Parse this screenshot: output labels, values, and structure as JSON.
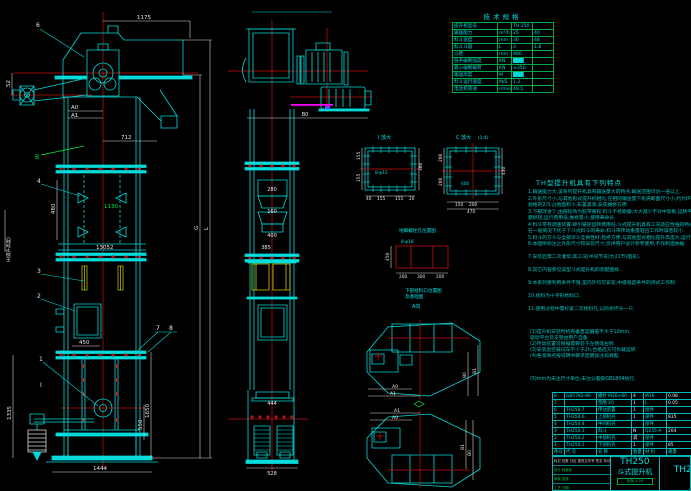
{
  "spec": {
    "title": "技术规格",
    "rows": [
      [
        "提升机型号",
        "",
        "TH 250",
        ""
      ],
      [
        "输送能力",
        "m³/h",
        "25",
        "40"
      ],
      [
        "料斗宽度",
        "mm",
        "30",
        "48"
      ],
      [
        "料斗斗容",
        "L",
        "3",
        "1.8"
      ],
      [
        "斗距",
        "mm",
        "480",
        ""
      ],
      [
        "链条破断强度",
        "KN",
        "███",
        ""
      ],
      [
        "最小破断载荷",
        "KN",
        "≥350",
        ""
      ],
      [
        "输送高度",
        "M",
        "███",
        ""
      ],
      [
        "料斗运行速度",
        "M/S",
        "1.2",
        ""
      ],
      [
        "电动机转速",
        "r/min",
        "48.5",
        ""
      ]
    ]
  },
  "notes": {
    "heading": "TH型提升机具有下列特点",
    "lines": [
      "1.输送能力大,该系列提升机具有输送量大的特点,输送范围可达一倍以上.",
      "2.外形尺寸小,与其他形式提升机相比,在相同输送量下机壳断面尺寸小,约为环链式同",
      "   规格的2/3,占地面积小,布置紧凑,安装维修方便.",
      "3.下部改进了,由链轮改为胶带重轮,料斗不易跑偏,大大减少不对中现象,运转平稳,",
      "   磨损轻,运行费用低,维修量小,使用寿命长.",
      "4.料斗带有调速装置,牵引链轮运转费用低,斗式提升机具有工况适应性强的特点,",
      "   在一般情况下优于下斗式料斗的寿命,料斗带传动重量轻且工作时噪音较小.",
      "5.料斗的方斗与全部深斗互换性好,检修方便,与其他型式相比提升高度大,运行平稳.",
      "6.本图所标注之外形尺寸和安装尺寸,仅供用户设计参考使用,不作制造依据.",
      "7.安装后需二次灌浆,其工况(中间节号)为21节(图号).",
      "8.其它内容参见该型斗式提升机的装配图样.",
      "9.本系列受利用条件不限,室内外均可安装,中级强度条件的闭式工作制.",
      "10.给料为十字形给料口.",
      "11.使用过程中需拧紧二次给料孔,以防损坏头一只."
    ],
    "sub": [
      "(1)提升机安装时机壳垂直度偏差不大于10mm,",
      "   驱动平台及支架由用户自备.",
      "(2)传动装置可根据需要装于左侧或右侧.",
      "(3)安装后空载试车不少于2h,合格后方可负载运转.",
      "(4)各润滑点按说明书要求定期加注润滑脂.",
      "(5)mm为未注尺寸单位,未注公差按GB1804执行."
    ]
  },
  "bom": {
    "headers": [
      "件号",
      "代  号",
      "名  称",
      "数量",
      "材  料",
      "重量"
    ],
    "rows": [
      [
        "8",
        "GB5782-86",
        "螺栓 M20×80",
        "4",
        "M16",
        "0.08"
      ],
      [
        "7",
        "",
        "垫圈 20",
        "1",
        "L",
        "0.05"
      ],
      [
        "6",
        "TH250.7",
        "传动装置",
        "1",
        "组件",
        ""
      ],
      [
        "5",
        "TH250.6",
        "上部机壳",
        "1",
        "部件",
        "835"
      ],
      [
        "4",
        "TH250.4",
        "中间机壳",
        "",
        "部件",
        ""
      ],
      [
        "3",
        "TH250.3",
        "料斗",
        "N",
        "Q235-A",
        "204"
      ],
      [
        "2",
        "TH250.2",
        "中部机壳",
        "袋",
        "部件",
        ""
      ],
      [
        "1",
        "TH250.1",
        "下部机壳",
        "1",
        "部件",
        "85"
      ]
    ]
  },
  "title_block": {
    "model": "TH250",
    "product": "斗式提升机",
    "model_right": "TH250",
    "scale": "比例 1:20",
    "rev_header": "标记 处数 分区 更改文件号 签名 年月日",
    "sig1": "设计    标准化",
    "sig2": "审核    批准",
    "sig3": "工艺    日期"
  },
  "dims": {
    "lv_top": "1175",
    "lv_spout": "712",
    "lv_52": "52",
    "a0": "A0",
    "a1": "A1",
    "lv_480": "480",
    "lv_1130": "1130",
    "lv_13052": "13052",
    "lv_450": "450",
    "lv_1335": "1335",
    "lv_1650": "1650",
    "lv_550": "550",
    "lv_1444": "1444",
    "g": "G",
    "l": "L",
    "h_label": "H(提升高度)",
    "cv_b0": "B0",
    "cv_280": "280",
    "cv_160": "160",
    "cv_400": "400",
    "cv_385": "385",
    "cv_444": "444",
    "cv_528": "528",
    "d1_label": "I 放大",
    "d1_360": "360",
    "d1_155a": "155",
    "d1_155b": "155",
    "d1_b40": "40",
    "d1_b155a": "155",
    "d1_b155b": "155",
    "d1_b20": "20",
    "d1_inner": "8-φ12",
    "d2_label": "C 放大",
    "d2_scale": "(1:4)",
    "d2_200a": "200",
    "d2_200b": "200",
    "d2_430": "430",
    "d2_150": "150",
    "d2_200c": "200",
    "d2_470": "470",
    "d2_600": "600",
    "an_title": "地脚螺栓孔位置图",
    "an_bolts": "8-φ18",
    "an_450": "450",
    "an_200a": "200",
    "an_300": "300",
    "an_200b": "200",
    "feed_1": "下部给料口位置图",
    "feed_2": "及基础图",
    "feed_a": "A向",
    "p1_a0": "A0",
    "p1_a1": "A1",
    "p1_b0": "B0",
    "p1_b1": "B1",
    "p2_a0": "A0",
    "p2_a1": "A1",
    "p2_b0": "B0",
    "p2_b1": "B1"
  },
  "labels": {
    "balloon_1": "1",
    "balloon_2": "2",
    "balloon_3": "3",
    "balloon_4": "4",
    "balloon_6": "6",
    "balloon_7": "7",
    "balloon_8": "8",
    "sec_i": "I",
    "sec_b": "B"
  }
}
